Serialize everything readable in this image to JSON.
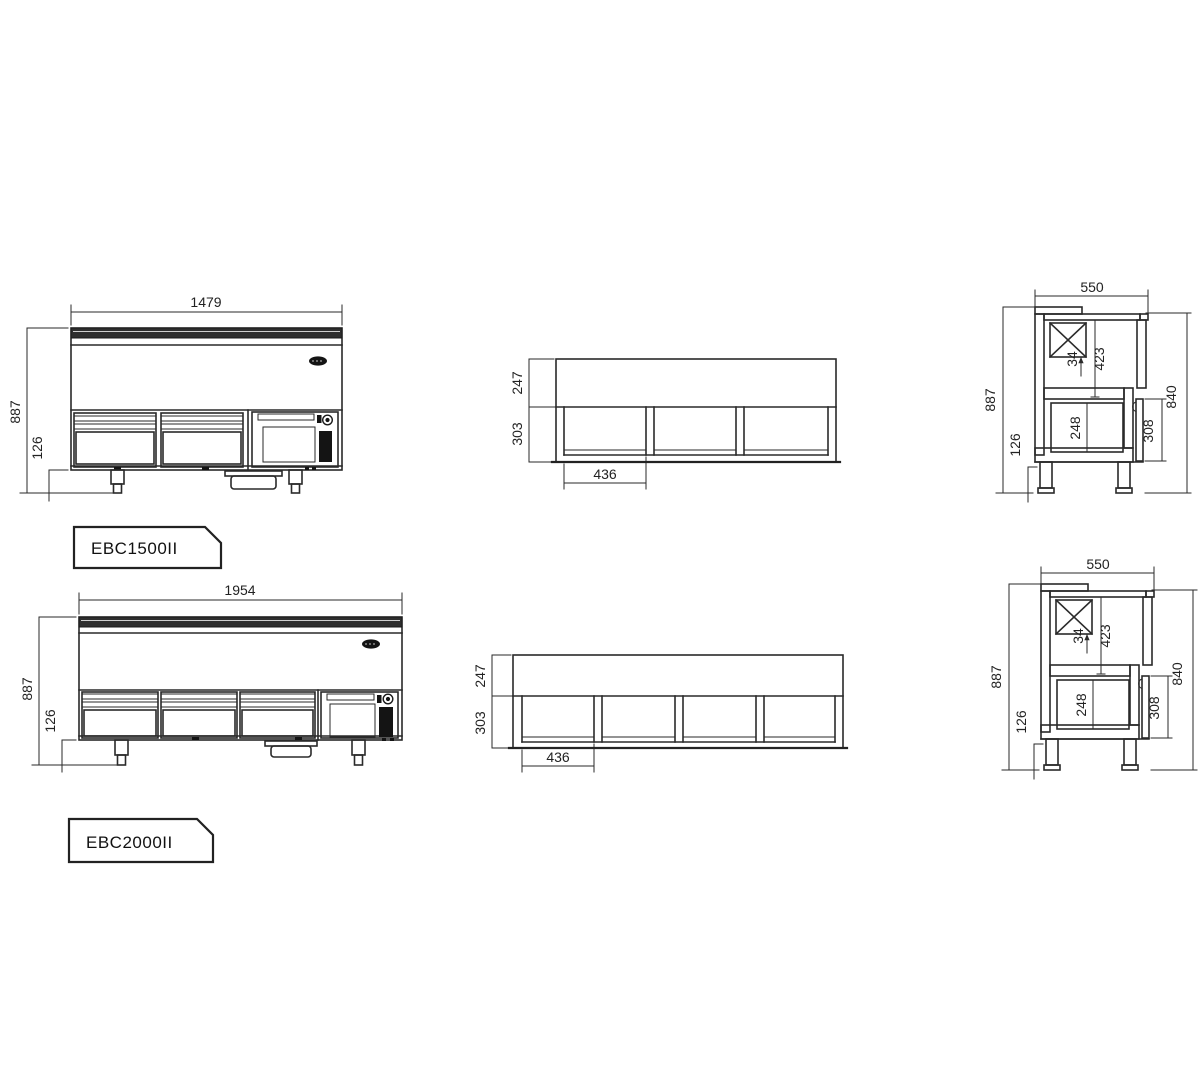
{
  "colors": {
    "line": "#2a2a2a",
    "dark_panel": "#141414",
    "worktop_band": "#2e2e2e",
    "background": "#ffffff"
  },
  "units": [
    {
      "model": "EBC1500II",
      "front": {
        "width": "1479",
        "height": "887",
        "legs": "126"
      },
      "plan": {
        "top_depth": "247",
        "well_depth": "303",
        "bay_width": "436"
      },
      "side": {
        "depth": "550",
        "height": "887",
        "legs": "126",
        "inner_height": "840",
        "evap_clearance": "34",
        "upper_cavity": "423",
        "drawer_cavity": "248",
        "door_height": "308"
      }
    },
    {
      "model": "EBC2000II",
      "front": {
        "width": "1954",
        "height": "887",
        "legs": "126"
      },
      "plan": {
        "top_depth": "247",
        "well_depth": "303",
        "bay_width": "436"
      },
      "side": {
        "depth": "550",
        "height": "887",
        "legs": "126",
        "inner_height": "840",
        "evap_clearance": "34",
        "upper_cavity": "423",
        "drawer_cavity": "248",
        "door_height": "308"
      }
    }
  ]
}
